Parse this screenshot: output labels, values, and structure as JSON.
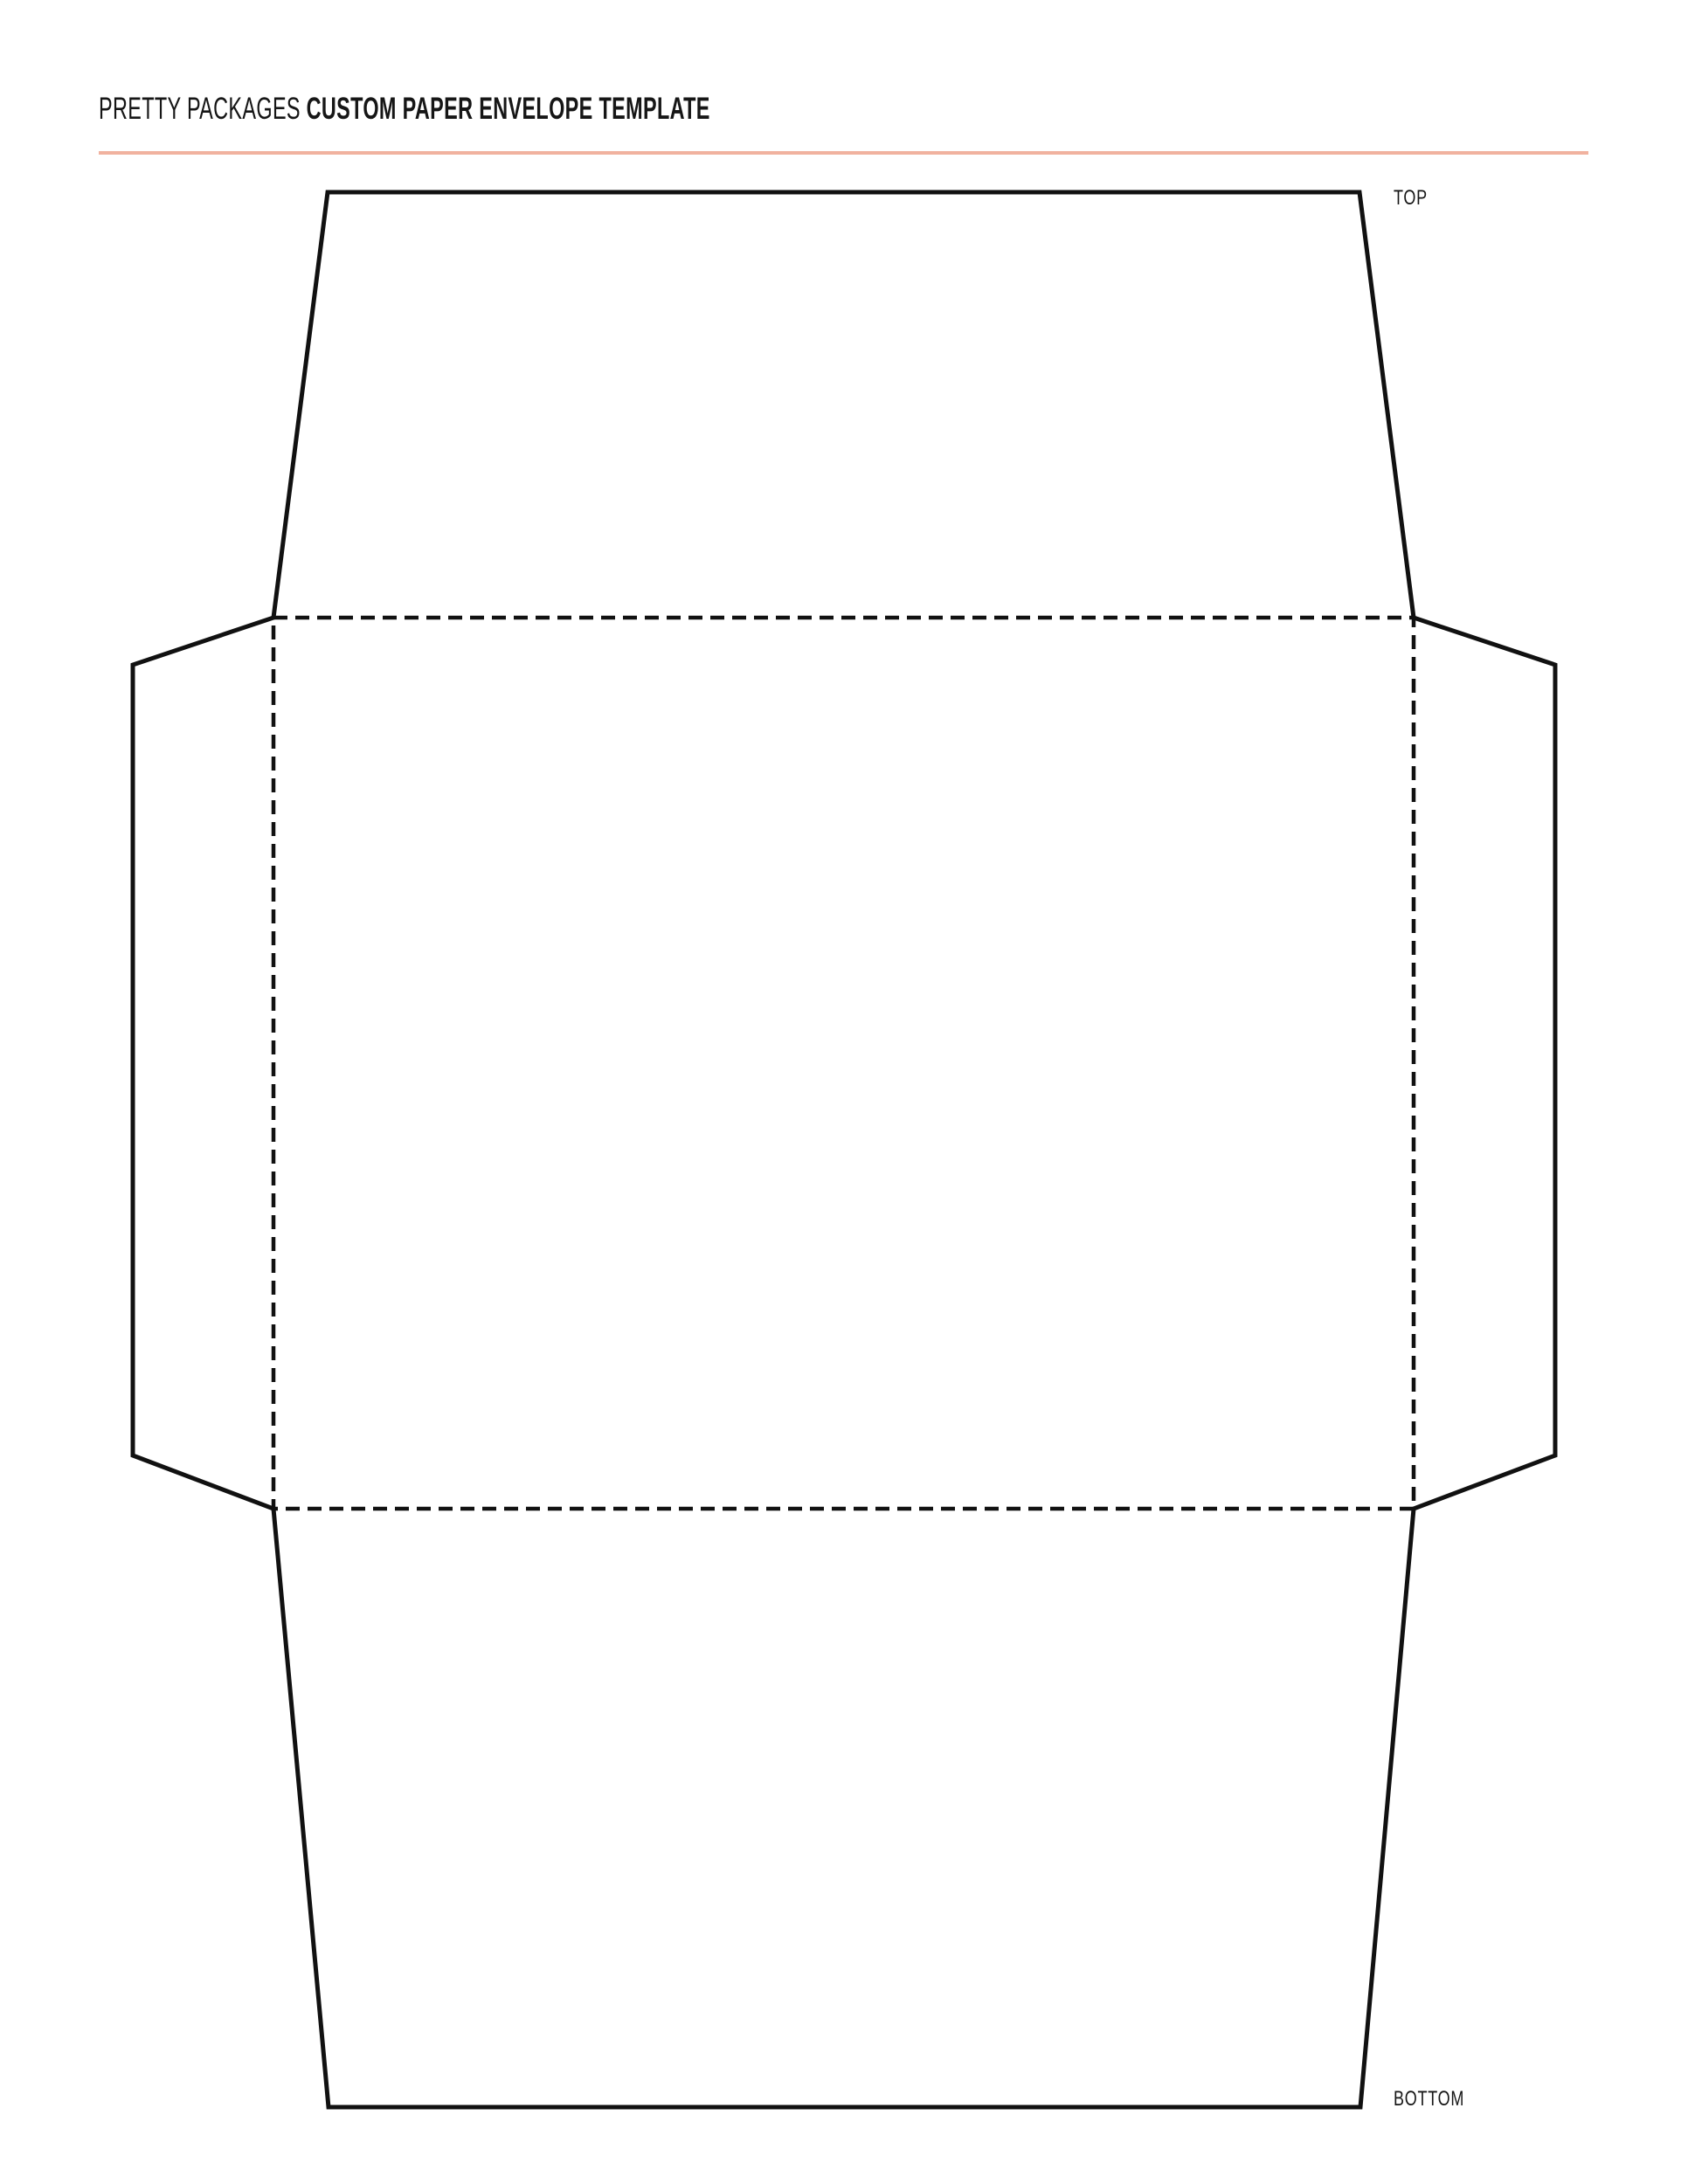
{
  "header": {
    "brand": "PRETTY PACKAGES",
    "title": "CUSTOM PAPER ENVELOPE TEMPLATE"
  },
  "diagram": {
    "labels": {
      "top": "TOP",
      "bottom": "BOTTOM"
    }
  },
  "colors": {
    "accent_line": "#f1b29f",
    "outline": "#111111",
    "text": "#161616",
    "background": "#ffffff"
  }
}
